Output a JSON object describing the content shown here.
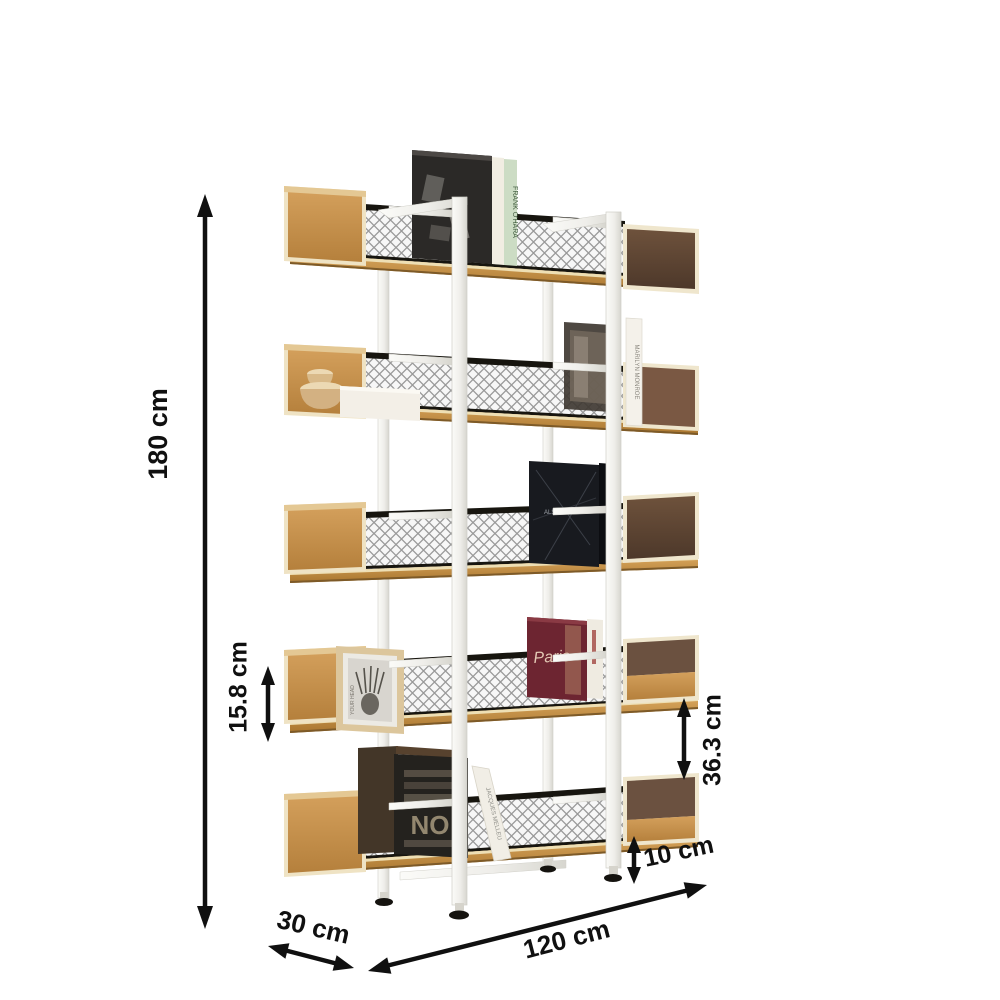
{
  "figure": {
    "type": "product dimension diagram",
    "subject": "5-tier oak and white-metal etagere bookshelf with mesh back panels",
    "background": "#ffffff"
  },
  "dimensions": {
    "overall_height": "180 cm",
    "side_box_height": "15.8 cm",
    "shelf_gap": "36.3 cm",
    "leg_height": "10 cm",
    "depth": "30 cm",
    "width": "120 cm"
  },
  "annotation": {
    "color": "#101010"
  },
  "materials": {
    "oak": "#c6924d",
    "walnut": "#5e4533",
    "frame_white": "#f3f2ee",
    "mesh_gray": "#919191",
    "edge_cream": "#efe2c2"
  },
  "decor": {
    "books": [
      {
        "name": "poetry-book",
        "spine_text": "FRANK O'HARA"
      },
      {
        "name": "marilyn-book",
        "spine_text": "MARILYN MONROE"
      },
      {
        "name": "also-book",
        "spine_text": "ALSO"
      },
      {
        "name": "paris-book",
        "cover_text": "Paris"
      },
      {
        "name": "typography-book",
        "cover_text": "NO"
      },
      {
        "name": "leaning-book",
        "spine_text": "JACQUES MELLEU"
      }
    ],
    "photo_frame_text": "YOUR HEAD"
  }
}
